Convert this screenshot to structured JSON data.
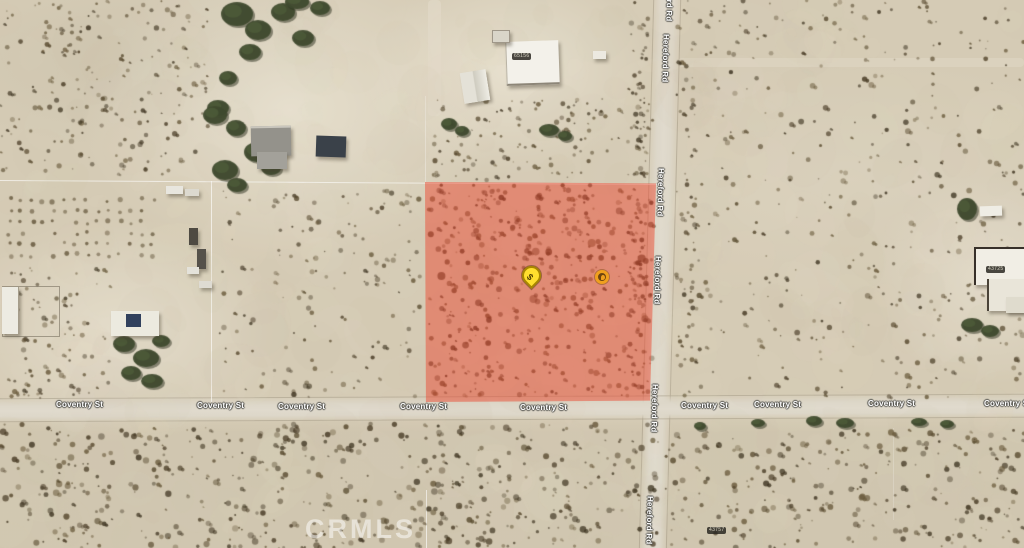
{
  "map": {
    "watermark_text": "CRMLS",
    "roads": {
      "hereford": {
        "name": "Hereford Rd",
        "orientation": "vertical",
        "label_count": 6
      },
      "coventry": {
        "name": "Coventry St",
        "orientation": "horizontal",
        "label_count": 9
      }
    },
    "markers": {
      "price_pin_label": "$",
      "secondary_marker": "photo-circle-marker"
    },
    "addresses": {
      "roof_top_mid": "65156",
      "house_right": "43725",
      "parcel_bottom_right": "43757"
    },
    "highlighted_parcel": {
      "description": "red highlighted land parcel at NW corner of Hereford Rd and Coventry St",
      "fill": "rgba(236,70,47,0.48)"
    },
    "colors": {
      "desert_base": "#d5cbb5",
      "road_surface": "#ddd7c9",
      "pin_fill": "#ffdf2e",
      "secondary_marker_ring": "#f0a01e",
      "parcel_highlight": "#ec462f"
    }
  }
}
